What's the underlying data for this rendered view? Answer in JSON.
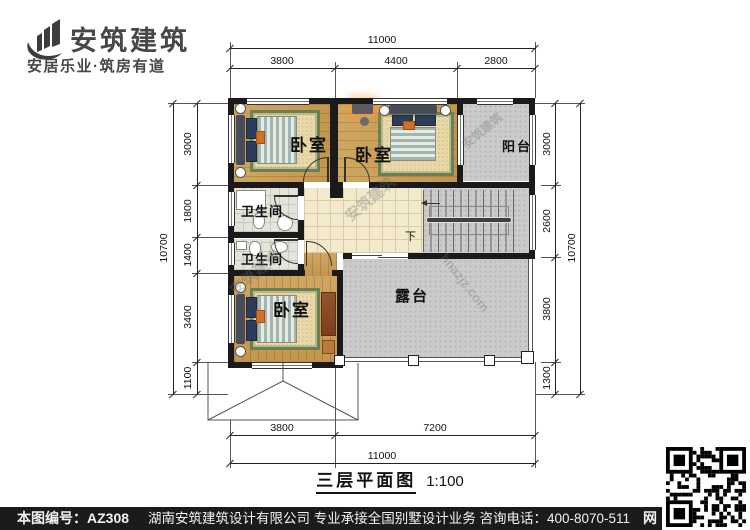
{
  "logo": {
    "name": "安筑建筑",
    "tagline": "安居乐业·筑房有道"
  },
  "plan": {
    "title": "三层平面图",
    "scale": "1:100",
    "rooms": {
      "bedroom_tl": "卧室",
      "bedroom_tm": "卧室",
      "bedroom_bl": "卧室",
      "bath1": "卫生间",
      "bath2": "卫生间",
      "balcony": "阳台",
      "terrace": "露台",
      "stairs_down": "下"
    },
    "dims": {
      "top_total": "11000",
      "top_segments": [
        "3800",
        "4400",
        "2800"
      ],
      "bottom_segments": [
        "3800",
        "7200"
      ],
      "bottom_total": "11000",
      "left_total": "10700",
      "left_segments": [
        "3000",
        "1800",
        "1400",
        "3400",
        "1100"
      ],
      "right_total": "10700",
      "right_segments": [
        "3000",
        "2600",
        "3800",
        "1300"
      ]
    }
  },
  "watermarks": {
    "brand": "安筑建筑",
    "site": "hnazjz.com"
  },
  "footer": {
    "sheet_no": "本图编号：AZ308",
    "company_line": "湖南安筑建筑设计有限公司  专业承接全国别墅设计业务  咨询电话：400-8070-511",
    "site_char": "网"
  },
  "colors": {
    "wall": "#1a1a1a",
    "wood": "#cfa761",
    "gray": "#cbcbcb",
    "hall_tile": "#f3e9cd",
    "rug_border": "#6d7f52",
    "footer_bar": "#1b1b1b"
  }
}
